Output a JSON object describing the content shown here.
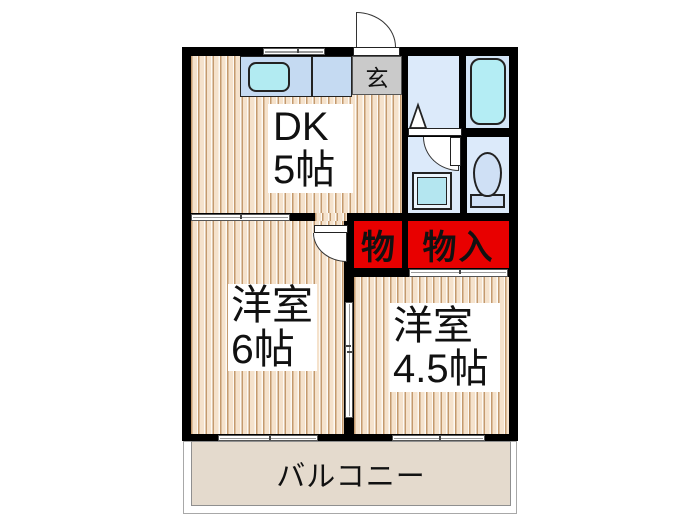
{
  "plan_type": "floorplan",
  "rooms": {
    "dk": {
      "name": "DK",
      "size": "5帖"
    },
    "genkan": {
      "name": "玄"
    },
    "room6": {
      "name": "洋室",
      "size": "6帖"
    },
    "room45": {
      "name": "洋室",
      "size": "4.5帖"
    },
    "closet_small": {
      "name": "物"
    },
    "closet_large": {
      "name": "物入"
    },
    "balcony": {
      "name": "バルコニー"
    }
  },
  "fixtures": [
    "kitchen-sink",
    "kitchen-counter",
    "bathtub",
    "toilet",
    "washing-machine",
    "laundry-pan-triangle",
    "entrance-door",
    "hinged-interior-doors",
    "sliding-doors",
    "sliding-windows"
  ],
  "colors": {
    "wall": "#000000",
    "floor_light": "#f5e2cc",
    "floor_grain": "#c49a6e",
    "wet_room_blue": "#dceafa",
    "fixture_blue": "#c5daf2",
    "sink_cyan": "#b2ebf2",
    "closet_red": "#e80000",
    "genkan_gray": "#cacaca",
    "balcony_beige": "#e4dacd",
    "background": "#ffffff"
  }
}
